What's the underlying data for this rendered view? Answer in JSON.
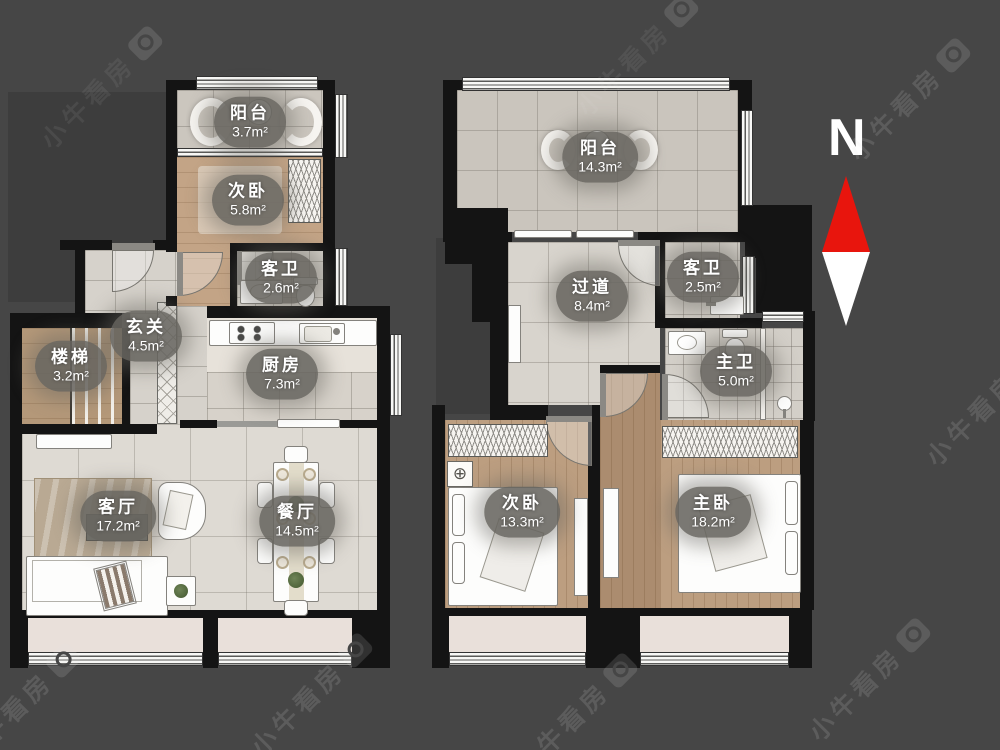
{
  "watermark": {
    "text": "小牛看房",
    "icon": "camera-icon"
  },
  "compass": {
    "label": "N",
    "north_color": "#e8150d",
    "south_color": "#ffffff"
  },
  "colors": {
    "background": "#464646",
    "wall": "#141414",
    "label_pill": "#68615f"
  },
  "plans": {
    "left": {
      "name": "lower-floor-plan",
      "rooms": [
        {
          "id": "balcony",
          "label": "阳台",
          "area": "3.7m²"
        },
        {
          "id": "bedroom2",
          "label": "次卧",
          "area": "5.8m²"
        },
        {
          "id": "guest-bath",
          "label": "客卫",
          "area": "2.6m²"
        },
        {
          "id": "foyer",
          "label": "玄关",
          "area": "4.5m²"
        },
        {
          "id": "stairs",
          "label": "楼梯",
          "area": "3.2m²"
        },
        {
          "id": "kitchen",
          "label": "厨房",
          "area": "7.3m²"
        },
        {
          "id": "living",
          "label": "客厅",
          "area": "17.2m²"
        },
        {
          "id": "dining",
          "label": "餐厅",
          "area": "14.5m²"
        }
      ]
    },
    "right": {
      "name": "upper-floor-plan",
      "rooms": [
        {
          "id": "balcony",
          "label": "阳台",
          "area": "14.3m²"
        },
        {
          "id": "hallway",
          "label": "过道",
          "area": "8.4m²"
        },
        {
          "id": "guest-bath",
          "label": "客卫",
          "area": "2.5m²"
        },
        {
          "id": "master-bath",
          "label": "主卫",
          "area": "5.0m²"
        },
        {
          "id": "bedroom2",
          "label": "次卧",
          "area": "13.3m²"
        },
        {
          "id": "master-bedroom",
          "label": "主卧",
          "area": "18.2m²"
        }
      ]
    }
  }
}
